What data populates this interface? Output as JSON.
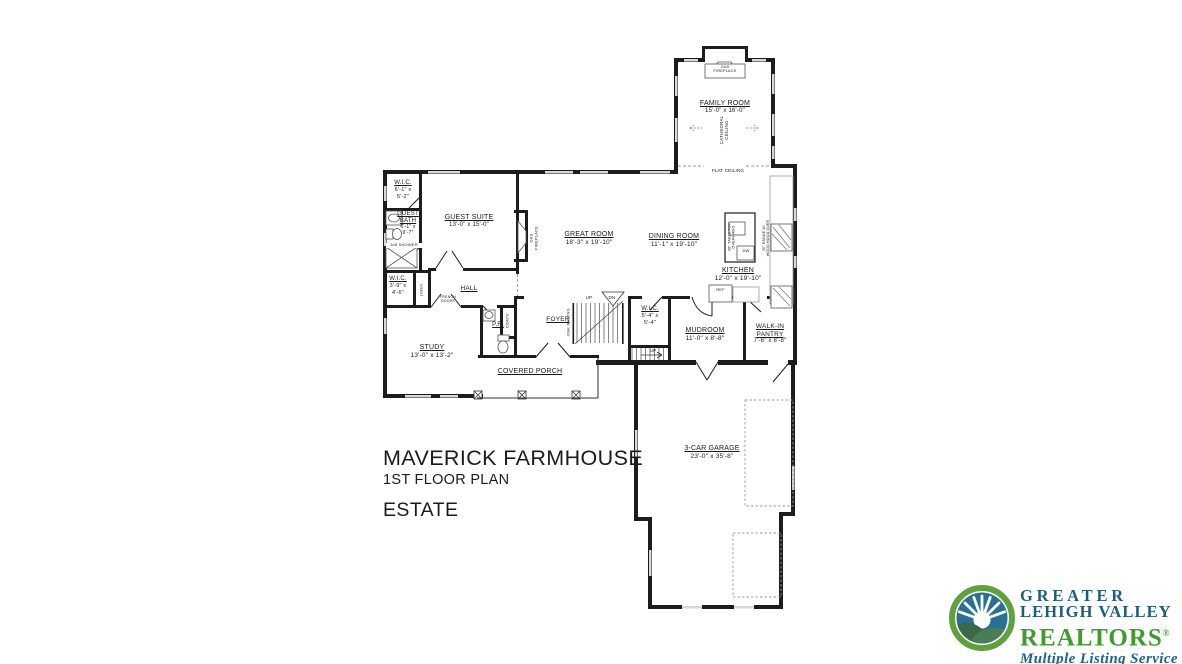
{
  "plan": {
    "line_color": "#1c1c1c",
    "rooms": {
      "family_room": {
        "name": "FAMILY ROOM",
        "dims": "15'-0\" x 16'-0\""
      },
      "guest_suite": {
        "name": "GUEST SUITE",
        "dims": "13'-0\" x 15'-0\""
      },
      "wic_guest": {
        "name": "W.I.C.",
        "dims_line1": "6'-1\" x",
        "dims_line2": "5'-2\""
      },
      "guest_bath": {
        "name_line1": "GUEST",
        "name_line2": "BATH",
        "dims_line1": "6'-1\" x",
        "dims_line2": "9'-7\""
      },
      "wic_hall": {
        "name": "W.I.C.",
        "dims_line1": "3'-9\" x",
        "dims_line2": "4'-6\""
      },
      "hall": {
        "name": "HALL"
      },
      "great_room": {
        "name": "GREAT ROOM",
        "dims": "18'-3\" x 19'-10\""
      },
      "dining_room": {
        "name": "DINING ROOM",
        "dims": "11'-1\" x 19'-10\""
      },
      "kitchen": {
        "name": "KITCHEN",
        "dims": "12'-0\" x 19'-10\""
      },
      "study": {
        "name": "STUDY",
        "dims": "13'-0\" x 13'-2\""
      },
      "powder_room": {
        "name": "P.R."
      },
      "foyer": {
        "name": "FOYER"
      },
      "wic_stairs": {
        "name": "W.I.C.",
        "dims_line1": "5'-4\" x",
        "dims_line2": "5'-4\""
      },
      "mudroom": {
        "name": "MUDROOM",
        "dims": "11'-0\" x 8'-8\""
      },
      "walk_in_pantry": {
        "name_line1": "WALK-IN",
        "name_line2": "PANTRY",
        "dims": "7'-6\" x 8'-8\""
      },
      "covered_porch": {
        "name": "COVERED PORCH"
      },
      "garage": {
        "name": "3-CAR GARAGE",
        "dims": "23'-0\" x 35'-8\""
      }
    },
    "annotations": {
      "gas_fireplace_family_line1": "GAS",
      "gas_fireplace_family_line2": "FIREPLACE",
      "gas_fireplace_great_line1": "GAS",
      "gas_fireplace_great_line2": "FIREPLACE",
      "cathedral_line1": "CATHEDRAL",
      "cathedral_line2": "CEILING",
      "flat_ceiling": "FLAT CEILING",
      "shower": "3x5 SHOWER",
      "linen": "LINEN",
      "coats": "COATS",
      "french_line1": "FRENCH",
      "french_line2": "DOORS",
      "oak_railing": "OAK RAILING",
      "up": "UP",
      "dn": "DN",
      "island_line1": "36\" TABLETOP",
      "island_line2": "OVERHANG",
      "range_line1": "36\" RANGE W/",
      "range_line2": "WOOD HOOD OVER",
      "dw": "DW",
      "ref": "REF"
    }
  },
  "title_block": {
    "plan_name": "MAVERICK FARMHOUSE",
    "floor": "1ST FLOOR PLAN",
    "series": "ESTATE"
  },
  "logo": {
    "org_line1": "GREATER",
    "org_line2": "LEHIGH VALLEY",
    "org_line3": "REALTORS",
    "registered_mark": "®",
    "tagline": "Multiple Listing Service",
    "colors": {
      "text_blue": "#1d5c7d",
      "realtors_green": "#3f9b2d",
      "tagline_blue": "#1e6290",
      "ring_green": "#5fa13c",
      "sky_blue": "#2a7095",
      "hill_dark": "#3c684a",
      "hill_light": "#4a7d55"
    }
  }
}
